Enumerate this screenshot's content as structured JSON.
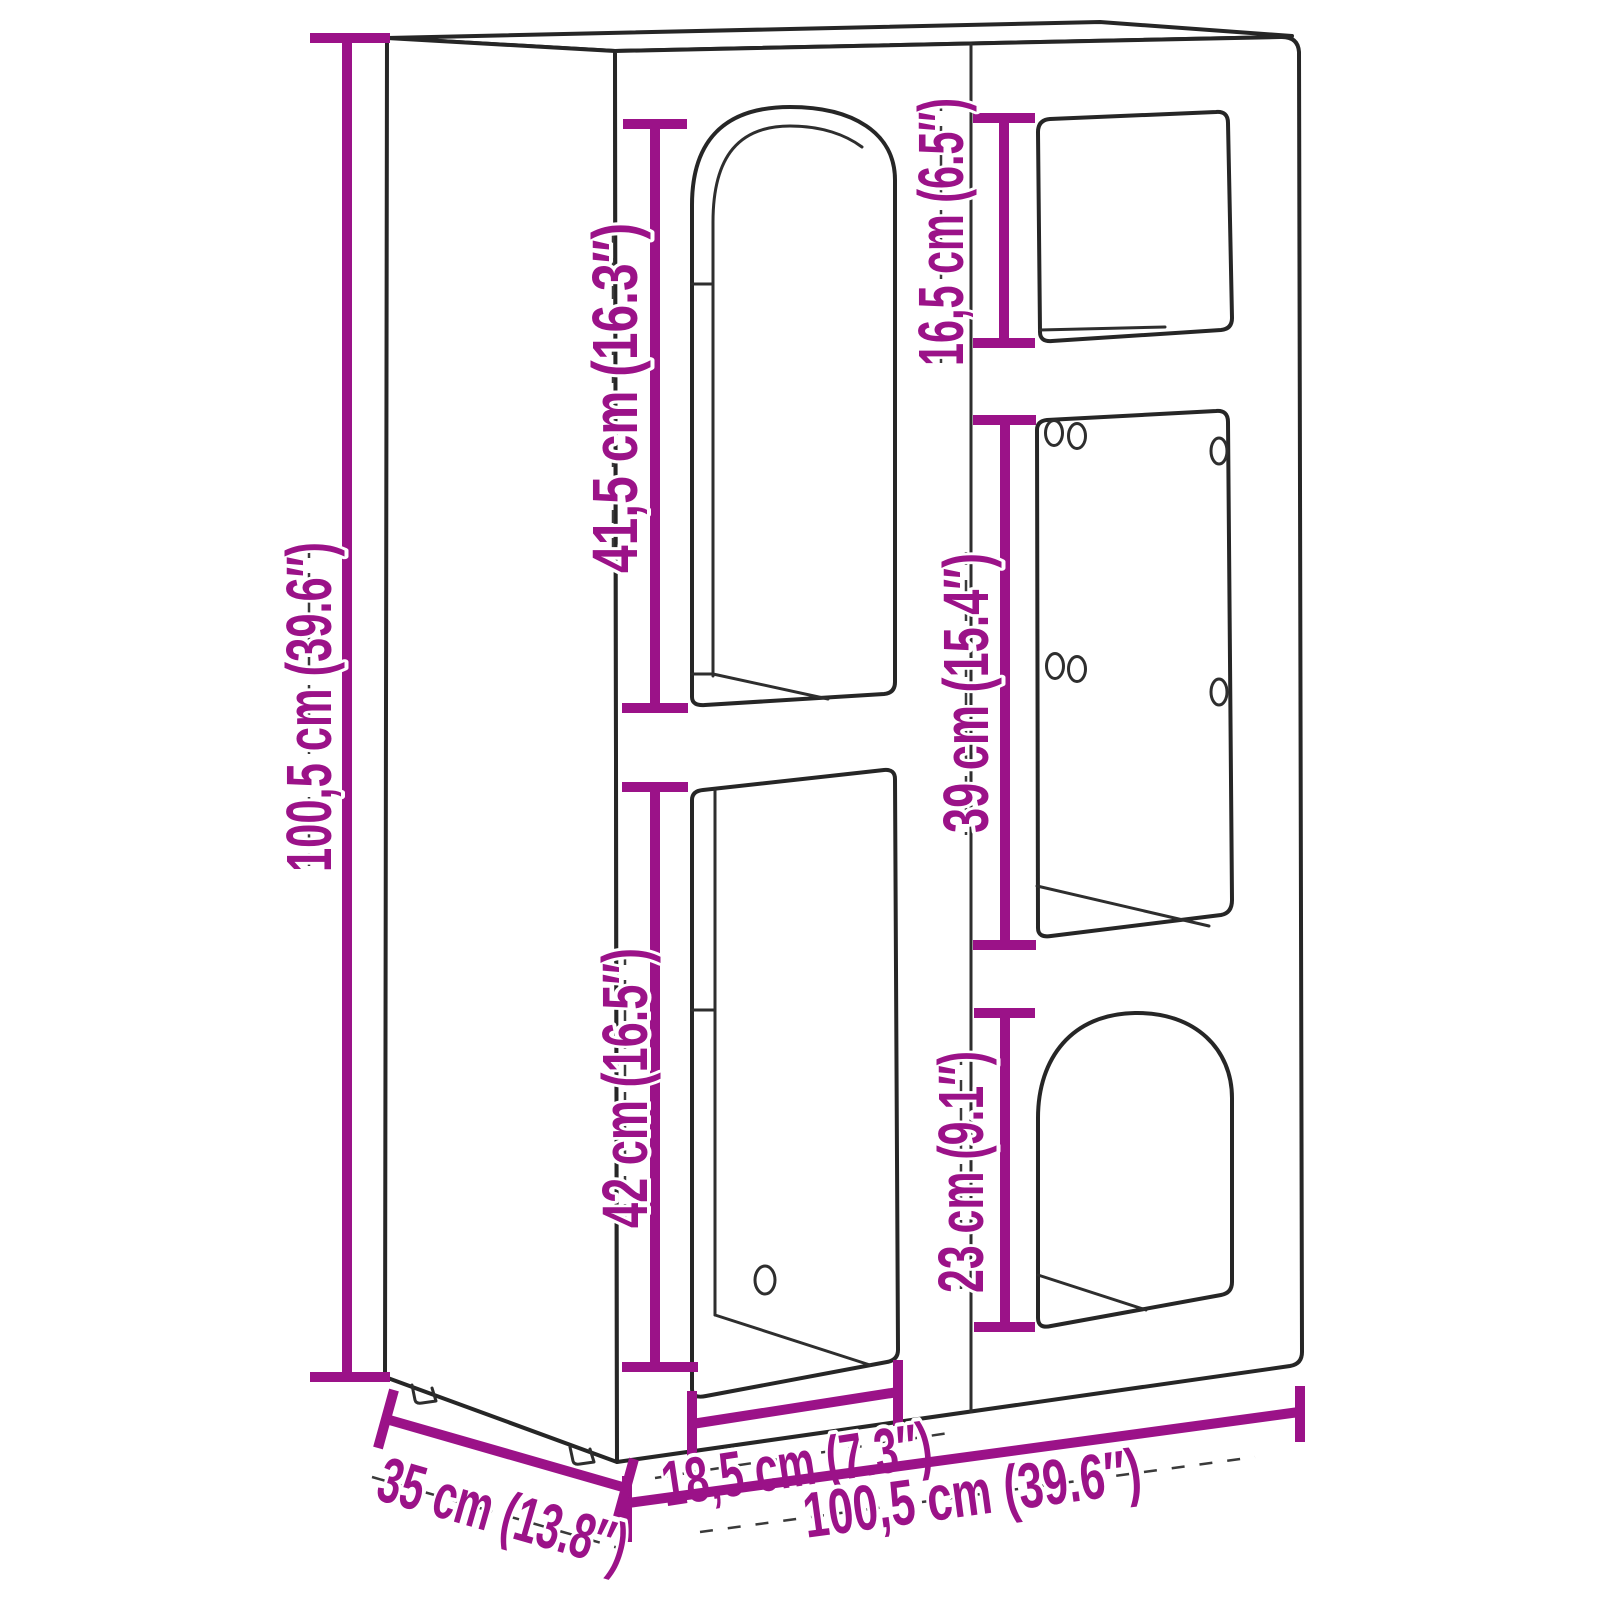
{
  "diagram": {
    "kind": "furniture-dimension-diagram",
    "subject": "cabinet with two arched and three rectangular compartments, 3D line drawing",
    "background_color": "#ffffff",
    "outline_color": "#262626",
    "accent_color": "#9B1288",
    "units": "cm (inches)",
    "dims": {
      "overall_height": {
        "label": "100,5 cm (39.6″)",
        "value_cm": "100,5",
        "value_in": "39.6",
        "measures": "overall height"
      },
      "upper_left_opening": {
        "label": "41,5 cm (16.3″)",
        "value_cm": "41,5",
        "value_in": "16.3",
        "measures": "upper left arched opening height"
      },
      "lower_left_opening": {
        "label": "42 cm (16.5″)",
        "value_cm": "42",
        "value_in": "16.5",
        "measures": "lower left opening height"
      },
      "top_right_opening": {
        "label": "16,5 cm (6.5″)",
        "value_cm": "16,5",
        "value_in": "6.5",
        "measures": "top right opening height"
      },
      "middle_right_opening": {
        "label": "39 cm (15.4″)",
        "value_cm": "39",
        "value_in": "15.4",
        "measures": "middle right opening height"
      },
      "bottom_right_opening": {
        "label": "23 cm (9.1″)",
        "value_cm": "23",
        "value_in": "9.1",
        "measures": "bottom right arched opening height"
      },
      "opening_width": {
        "label": "18,5 cm (7.3″)",
        "value_cm": "18,5",
        "value_in": "7.3",
        "measures": "lower opening width"
      },
      "overall_width": {
        "label": "100,5 cm (39.6″)",
        "value_cm": "100,5",
        "value_in": "39.6",
        "measures": "overall width"
      },
      "overall_depth": {
        "label": "35 cm (13.8″)",
        "value_cm": "35",
        "value_in": "13.8",
        "measures": "overall depth"
      }
    }
  }
}
